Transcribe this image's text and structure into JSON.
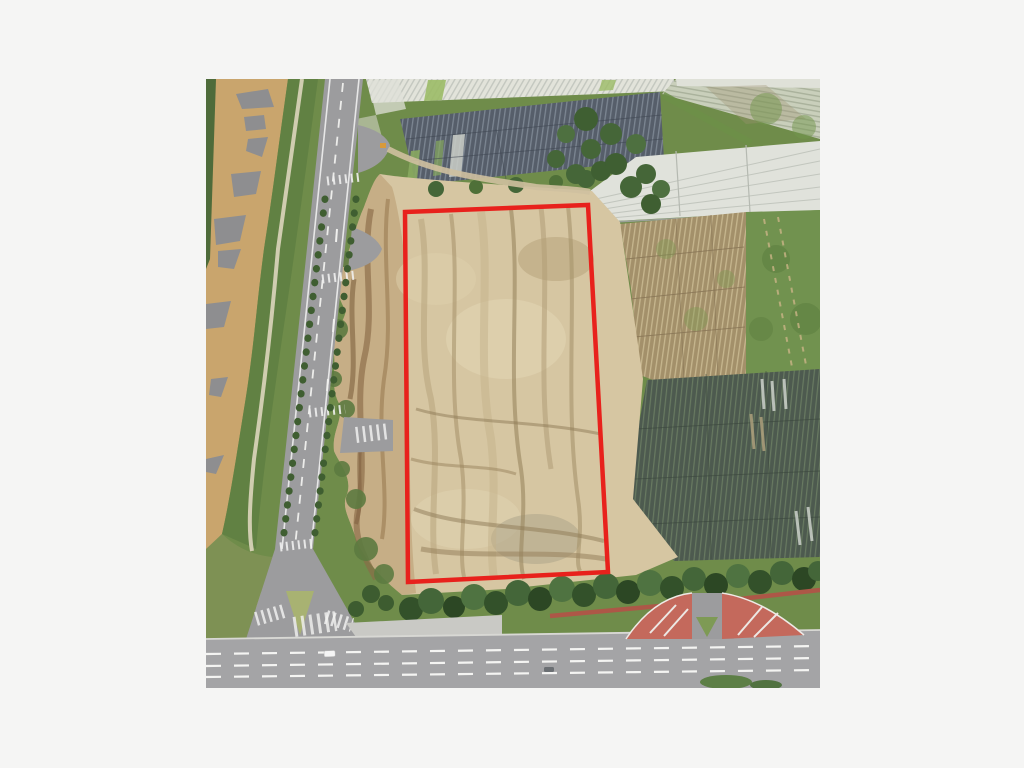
{
  "page": {
    "background": "#f5f5f4"
  },
  "photo": {
    "left": 206,
    "top": 79,
    "width": 614,
    "height": 609,
    "type": "aerial-photograph",
    "view": "oblique satellite / drone view",
    "description": "Cleared dirt land parcel outlined in red, muddy river and tree-lined road to the west, plastic-mulch farm fields and greenhouses to the north and east, tree line with red wall and a wide boulevard to the south"
  },
  "annotation": {
    "name": "parcel-boundary",
    "shape": "quadrilateral",
    "color": "#e8211c",
    "stroke_width": 4.5,
    "points": "199,133 382,126 402,493 202,503"
  },
  "palette": {
    "page_background": "#f5f5f4",
    "annotation_red": "#e8211c",
    "river": "#c9a56d",
    "sandbar": "#8e8e90",
    "vegetation": "#6f8c4a",
    "trees_dark": "#3c5a2e",
    "road": "#9c9c9e",
    "boulevard": "#a4a4a6",
    "road_markings": "#f0f0ee",
    "dark_gray_field": "#565e6a",
    "dark_mulch_field": "#4d5a4f",
    "pale_greenhouse": "#e0e2db",
    "brown_field": "#a3906a",
    "gray_green_field": "#c9cfbb",
    "grass_field": "#71924f",
    "parcel_dirt": "#d6c6a2",
    "eroded_slope": "#b99a6f",
    "red_wall": "#ad5747",
    "red_pavement": "#c4695c"
  },
  "features": [
    {
      "name": "muddy-river",
      "desc": "brown silt river with grey sandbars, upper left"
    },
    {
      "name": "riverside-greenway",
      "desc": "green embankment with light footpath along river"
    },
    {
      "name": "two-lane-road",
      "desc": "tree-lined road with markings and junction flares"
    },
    {
      "name": "greenhouse-plastic-fields",
      "desc": "rows of plastic-covered crop beds, north and east"
    },
    {
      "name": "white-greenhouse-band",
      "desc": "long pale greenhouse roof band, east side"
    },
    {
      "name": "cleared-parcel",
      "desc": "bare graded earth parcel outlined in red"
    },
    {
      "name": "eroded-slope",
      "desc": "rutted brown slope between road and parcel"
    },
    {
      "name": "southern-tree-line",
      "desc": "dense trees with red wall along boulevard"
    },
    {
      "name": "boulevard",
      "desc": "wide road with dashed lane lines, bottom"
    },
    {
      "name": "red-paved-junction",
      "desc": "red surfaced entrance flares, lower right"
    }
  ]
}
